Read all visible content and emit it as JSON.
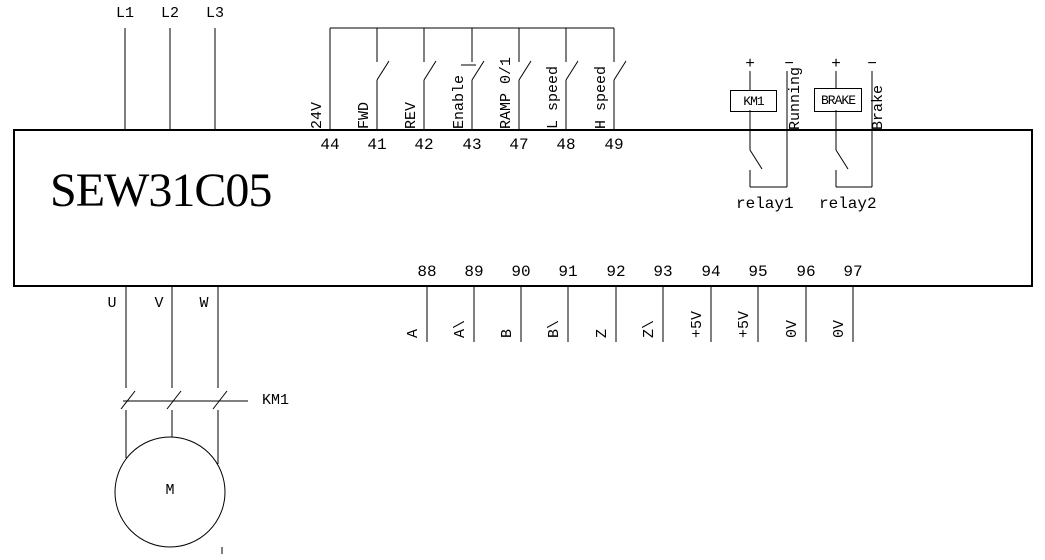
{
  "device": {
    "title": "SEW31C05"
  },
  "colors": {
    "line": "#000000",
    "background": "#ffffff"
  },
  "power_input": {
    "lines": [
      "L1",
      "L2",
      "L3"
    ]
  },
  "control_terminals": {
    "items": [
      {
        "num": "44",
        "label": "24V"
      },
      {
        "num": "41",
        "label": "FWD"
      },
      {
        "num": "42",
        "label": "REV"
      },
      {
        "num": "43",
        "label": "Enable"
      },
      {
        "num": "47",
        "label": "RAMP 0/1"
      },
      {
        "num": "48",
        "label": "L speed"
      },
      {
        "num": "49",
        "label": "H speed"
      }
    ]
  },
  "relay_outputs": {
    "relay1": {
      "plus": "+",
      "minus": "−",
      "coil": "KM1",
      "signal": "Running",
      "name": "relay1"
    },
    "relay2": {
      "plus": "+",
      "minus": "−",
      "coil": "BRAKE",
      "signal": "Brake",
      "name": "relay2"
    }
  },
  "motor_output": {
    "phases": [
      "U",
      "V",
      "W"
    ],
    "contactor": "KM1",
    "motor": "M"
  },
  "encoder_terminals": {
    "items": [
      {
        "num": "88",
        "label": "A"
      },
      {
        "num": "89",
        "label": "A\\"
      },
      {
        "num": "90",
        "label": "B"
      },
      {
        "num": "91",
        "label": "B\\"
      },
      {
        "num": "92",
        "label": "Z"
      },
      {
        "num": "93",
        "label": "Z\\"
      },
      {
        "num": "94",
        "label": "+5V"
      },
      {
        "num": "95",
        "label": "+5V"
      },
      {
        "num": "96",
        "label": "0V"
      },
      {
        "num": "97",
        "label": "0V"
      }
    ]
  }
}
